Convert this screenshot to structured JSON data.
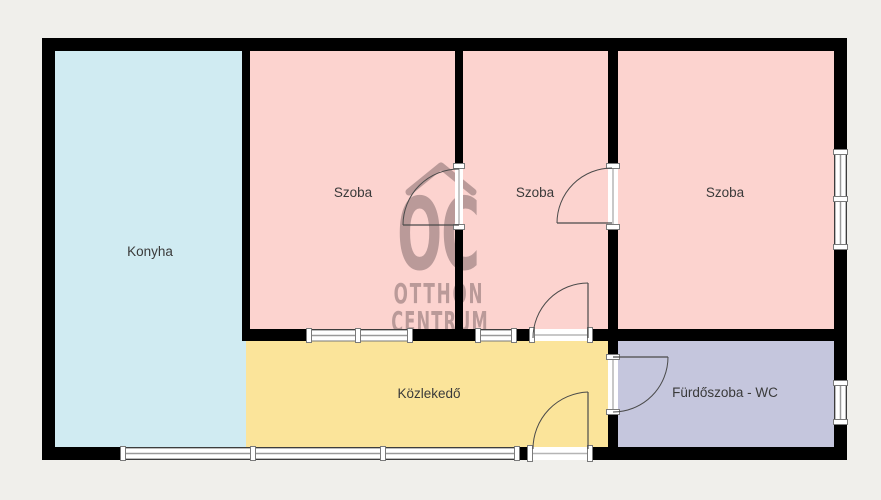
{
  "page": {
    "width": 881,
    "height": 500,
    "background": "#f0efeb"
  },
  "floorplan": {
    "wall_color": "#000000",
    "label_color": "#3a3a3a",
    "window_frame_color": "#7a7a7a",
    "window_glass_color": "#ffffff",
    "door_line_color": "#4a4a4a",
    "watermark": {
      "color": "#5a474b",
      "opacity": 0.4,
      "roof_path": "M409,192 L441,166 L473,192",
      "lines": [
        {
          "text": "OC",
          "x": 438,
          "y": 269,
          "size": 100,
          "sx": 0.53,
          "ls": -2
        },
        {
          "text": "OTTHON",
          "x": 439,
          "y": 303,
          "size": 28,
          "sx": 0.6,
          "ls": 3
        },
        {
          "text": "CENTRUM",
          "x": 440,
          "y": 331,
          "size": 28,
          "sx": 0.58,
          "ls": 2
        }
      ]
    },
    "rooms": [
      {
        "id": "konyha",
        "label": "Konyha",
        "color": "#d0ebf2",
        "x": 55,
        "y": 51,
        "w": 191,
        "h": 396,
        "lx": 150,
        "ly": 256
      },
      {
        "id": "szoba-1",
        "label": "Szoba",
        "color": "#fcd3cf",
        "x": 250,
        "y": 51,
        "w": 205,
        "h": 278,
        "lx": 353,
        "ly": 197
      },
      {
        "id": "szoba-2",
        "label": "Szoba",
        "color": "#fcd3cf",
        "x": 463,
        "y": 51,
        "w": 145,
        "h": 278,
        "lx": 535,
        "ly": 197
      },
      {
        "id": "szoba-3",
        "label": "Szoba",
        "color": "#fcd3cf",
        "x": 618,
        "y": 51,
        "w": 216,
        "h": 278,
        "lx": 725,
        "ly": 197
      },
      {
        "id": "kozlekedo",
        "label": "Közlekedő",
        "color": "#fbe49a",
        "x": 246,
        "y": 341,
        "w": 362,
        "h": 106,
        "lx": 429,
        "ly": 398
      },
      {
        "id": "furdoszoba",
        "label": "Fürdőszoba - WC",
        "color": "#c5c6dd",
        "x": 618,
        "y": 341,
        "w": 216,
        "h": 106,
        "lx": 725,
        "ly": 397
      }
    ],
    "walls": [
      {
        "id": "top-wall",
        "x": 42,
        "y": 38,
        "w": 805,
        "h": 13
      },
      {
        "id": "bottom-wall",
        "x": 42,
        "y": 447,
        "w": 805,
        "h": 13
      },
      {
        "id": "left-wall",
        "x": 42,
        "y": 38,
        "w": 13,
        "h": 422
      },
      {
        "id": "right-wall",
        "x": 834,
        "y": 38,
        "w": 13,
        "h": 422
      },
      {
        "id": "konyha-szoba1-wall",
        "x": 242,
        "y": 51,
        "w": 8,
        "h": 290
      },
      {
        "id": "szoba1-szoba2-wall",
        "x": 455,
        "y": 51,
        "w": 8,
        "h": 290
      },
      {
        "id": "szoba2-szoba3-wall",
        "x": 608,
        "y": 51,
        "w": 10,
        "h": 396
      },
      {
        "id": "middle-cross-wall",
        "x": 242,
        "y": 329,
        "w": 592,
        "h": 12
      }
    ],
    "windows": [
      {
        "id": "balcony-window",
        "dir": "h",
        "x": 123,
        "y": 448,
        "w": 394,
        "h": 11,
        "dividers": [
          253,
          383
        ]
      },
      {
        "id": "szoba3-window",
        "dir": "v",
        "x": 835,
        "y": 152,
        "w": 11,
        "h": 95,
        "dividers": [
          199
        ]
      },
      {
        "id": "furdoszoba-window",
        "dir": "v",
        "x": 835,
        "y": 383,
        "w": 11,
        "h": 39,
        "dividers": []
      },
      {
        "id": "szoba1-interior-window",
        "dir": "h",
        "x": 309,
        "y": 330,
        "w": 101,
        "h": 11,
        "dividers": [
          358
        ]
      },
      {
        "id": "szoba2-interior-window",
        "dir": "h",
        "x": 478,
        "y": 330,
        "w": 36,
        "h": 11,
        "dividers": []
      }
    ],
    "doors": [
      {
        "id": "szoba1-szoba2-door",
        "dir": "v",
        "x": 455,
        "y": 166,
        "w": 8,
        "h": 61,
        "leaf": {
          "x1": 403,
          "y1": 225,
          "x2": 459,
          "y2": 225
        },
        "arc": "M403,225 A56,56 0 0 1 459,169"
      },
      {
        "id": "szoba2-szoba3-door",
        "dir": "v",
        "x": 608,
        "y": 166,
        "w": 10,
        "h": 61,
        "leaf": {
          "x1": 557,
          "y1": 223,
          "x2": 612,
          "y2": 223
        },
        "arc": "M557,223 A55,55 0 0 1 612,168"
      },
      {
        "id": "szoba2-kozlekedo-door",
        "dir": "h",
        "x": 532,
        "y": 329,
        "w": 58,
        "h": 12,
        "leaf": {
          "x1": 588,
          "y1": 283,
          "x2": 588,
          "y2": 338
        },
        "arc": "M533,338 A55,55 0 0 1 588,283"
      },
      {
        "id": "furdoszoba-door",
        "dir": "v",
        "x": 608,
        "y": 357,
        "w": 10,
        "h": 55,
        "leaf": {
          "x1": 613,
          "y1": 357,
          "x2": 668,
          "y2": 357
        },
        "arc": "M668,357 A55,55 0 0 1 613,412"
      },
      {
        "id": "entrance-door",
        "dir": "h",
        "x": 530,
        "y": 447,
        "w": 60,
        "h": 13,
        "leaf": {
          "x1": 588,
          "y1": 392,
          "x2": 588,
          "y2": 449
        },
        "arc": "M588,392 A57,57 0 0 0 533,449"
      }
    ]
  }
}
